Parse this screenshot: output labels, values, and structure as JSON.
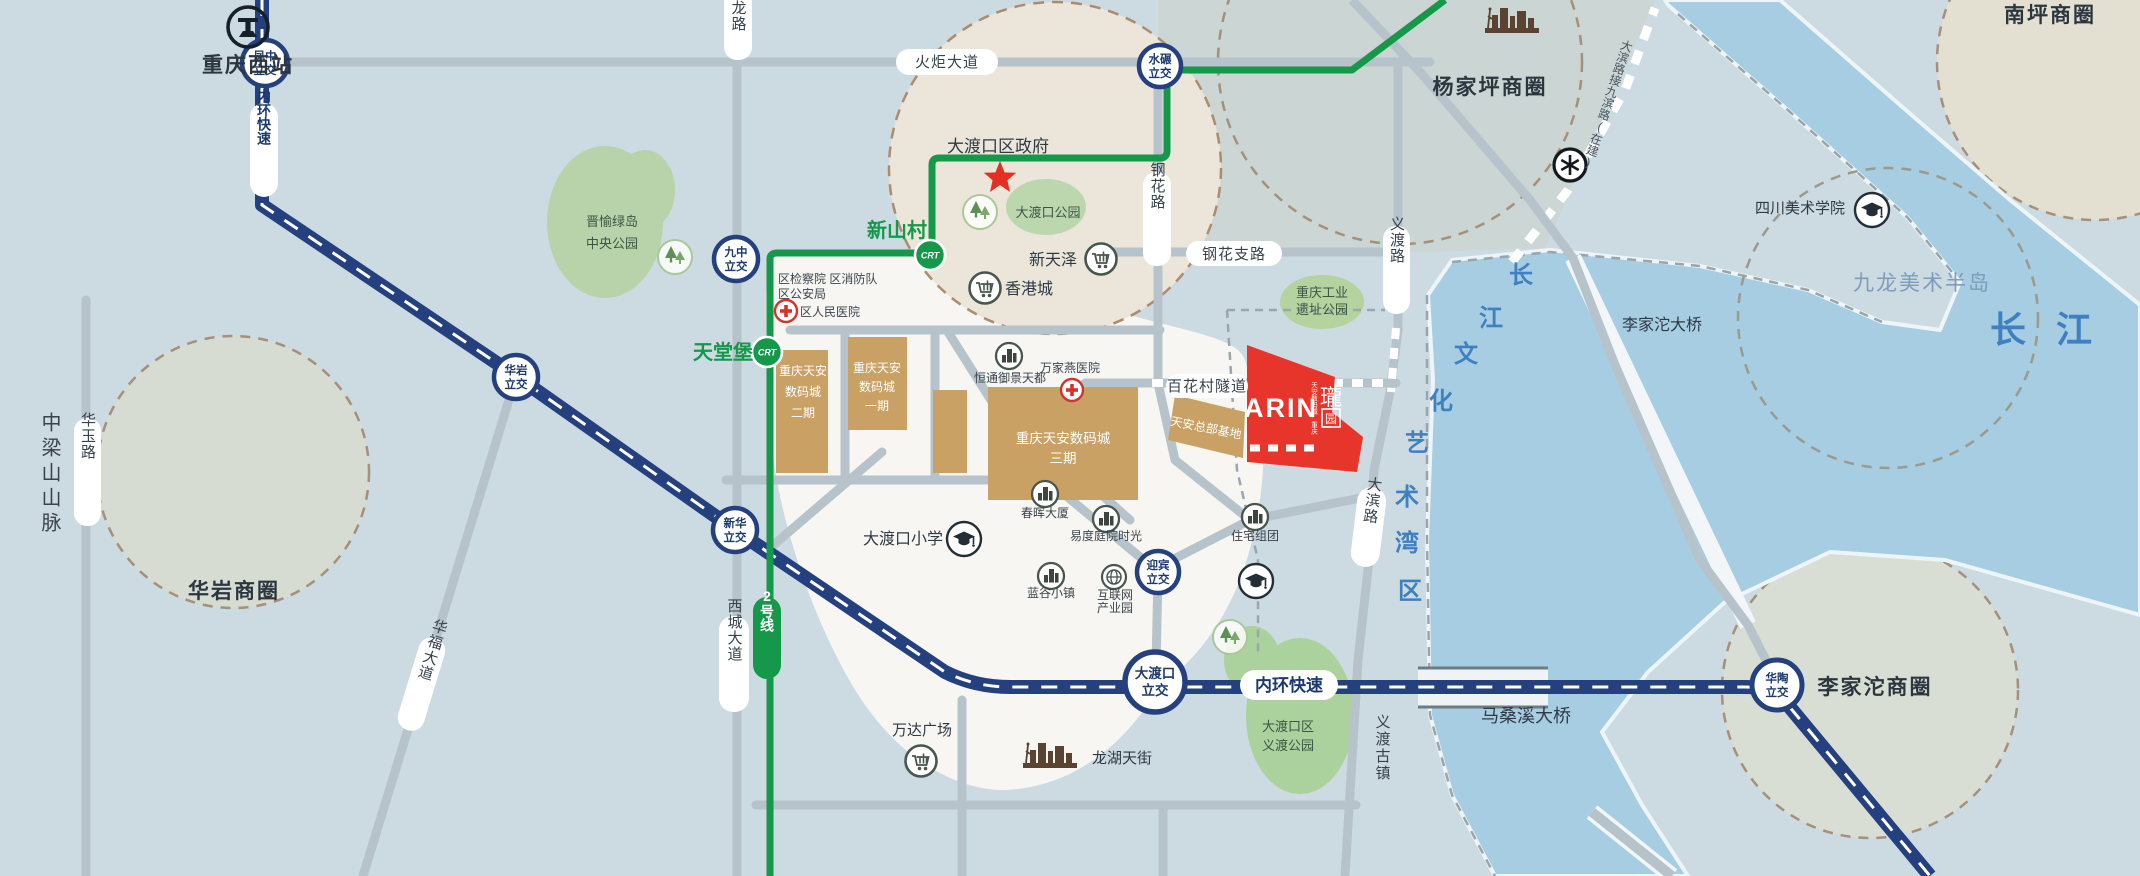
{
  "colors": {
    "background": "#ccdae2",
    "water": "#a6cde2",
    "expressway_navy": "#24407e",
    "metro_green": "#16984a",
    "road_gray": "#b7c3ca",
    "district_white": "#f7f6f2",
    "gov_beige": "#ebe6d9",
    "park_green": "#b7d4a8",
    "building_tan": "#c9a164",
    "project_red": "#e8352b",
    "river_text_blue": "#3a7ec6",
    "dash_brown": "#a5907a"
  },
  "stations": {
    "line_badge": "2号线",
    "xinshancun": "新山村",
    "tiantangbao": "天堂堡"
  },
  "expressway": {
    "inner_ring": "内环快速"
  },
  "interchanges": {
    "fengzhong": [
      "凤中",
      "立交"
    ],
    "shuinian": [
      "水碾",
      "立交"
    ],
    "jiuzhong": [
      "九中",
      "立交"
    ],
    "huayan": [
      "华岩",
      "立交"
    ],
    "xinhua": [
      "新华",
      "立交"
    ],
    "yingbin": [
      "迎宾",
      "立交"
    ],
    "dadukou": [
      "大渡口",
      "立交"
    ],
    "huatao": [
      "华陶",
      "立交"
    ]
  },
  "roads": {
    "yilong": "翼龙路",
    "huoju": "火炬大道",
    "ganghua": "钢花路",
    "ganghua_branch": "钢花支路",
    "yidu": "义渡路",
    "dabin": "大滨路",
    "xicheng": "西城大道",
    "huayu": "华玉路",
    "huafu": "华福大道",
    "baihuacun_tunnel": "百花村隧道",
    "dabin_note": "大滨路接九滨路(在建)"
  },
  "bridges": {
    "masangxi": "马桑溪大桥",
    "lijiatuo": "李家沱大桥"
  },
  "districts": {
    "yangjiaping": "杨家坪商圈",
    "nanping": "南坪商圈",
    "huayan": "华岩商圈",
    "lijiatuo": "李家沱商圈",
    "jiulong_peninsula": "九龙美术半岛",
    "changjiang": "长 江",
    "art_bay": [
      "长",
      "江",
      "文",
      "化",
      "艺",
      "术",
      "湾",
      "区"
    ],
    "zhongliangshan": "中梁山山脉",
    "yidu_ancient_town": "义渡古镇"
  },
  "places": {
    "chongqing_west": "重庆西站",
    "gov": "大渡口区政府",
    "ddk_park": "大渡口公园",
    "xintianze": "新天泽",
    "hongkong_city": "香港城",
    "procuratorate": "区检察院 区消防队",
    "public_security": "区公安局",
    "people_hospital": "区人民医院",
    "hengtong": "恒通御景天都",
    "wanjiayan": "万家燕医院",
    "phase2": [
      "重庆天安",
      "数码城",
      "二期"
    ],
    "phase1": [
      "重庆天安",
      "数码城",
      "一期"
    ],
    "phase3": [
      "重庆天安数码城",
      "三期"
    ],
    "hq_base": "天安总部基地",
    "residence": "住宅组团",
    "chunhui": "春晖大厦",
    "yidu_time": "易度庭院时光",
    "langu": "蓝谷小镇",
    "internet": [
      "互联网",
      "产业园"
    ],
    "ddk_primary": "大渡口小学",
    "wanda": "万达广场",
    "longhu": "龙湖天街",
    "yidu_park": [
      "大渡口区",
      "义渡公园"
    ],
    "industrial_park": [
      "重庆工业",
      "遗址公园"
    ],
    "jinyu": [
      "晋愉绿岛",
      "中央公园"
    ],
    "sichuan_academy": "四川美术学院"
  },
  "project": {
    "latin": "ARIN",
    "sub": "天安数码城·重庆",
    "cn": "瓏",
    "seal": "园"
  }
}
